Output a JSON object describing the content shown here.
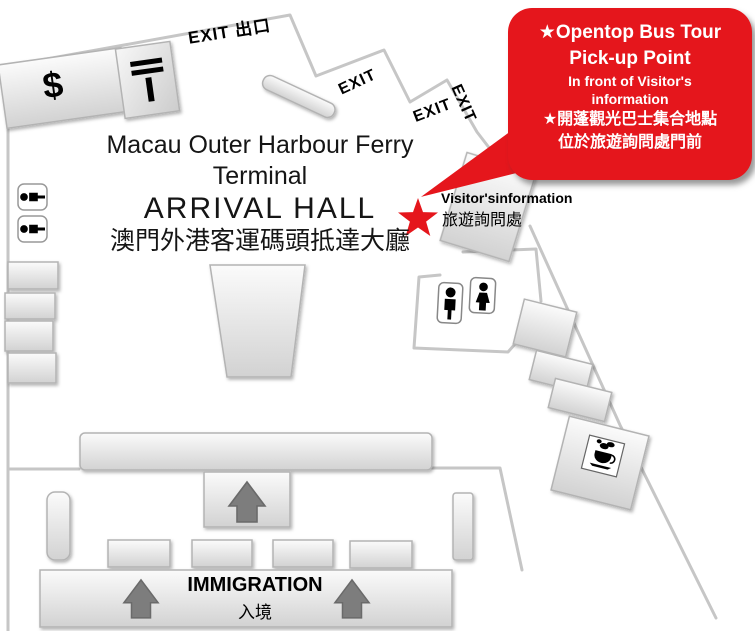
{
  "callout": {
    "en_title_1": "★Opentop Bus Tour",
    "en_title_2": "Pick-up Point",
    "en_sub_1": "In front of Visitor's",
    "en_sub_2": "information",
    "zh_1": "★開蓬觀光巴士集合地點",
    "zh_2": "位於旅遊詢問處門前"
  },
  "terminal": {
    "name_en_1": "Macau Outer Harbour Ferry",
    "name_en_2": "Terminal",
    "hall_en": "ARRIVAL HALL",
    "hall_zh": "澳門外港客運碼頭抵達大廳"
  },
  "exits": {
    "main": "EXIT 出口",
    "exit_1": "EXIT",
    "exit_2": "EXIT",
    "exit_3": "EXIT"
  },
  "visitor_info": {
    "en": "Visitor'sinformation",
    "zh": "旅遊詢問處"
  },
  "immigration": {
    "en": "IMMIGRATION",
    "zh": "入境"
  },
  "facilities": {
    "currency_sign": "$"
  },
  "icons": {
    "pickup_star": "★",
    "exchange_counter": "double-bar-T-icon",
    "male_restroom": "male-restroom-icon",
    "female_restroom": "female-restroom-icon",
    "cafe": "coffee-cup-icon",
    "direction": "up-arrow-icon"
  },
  "colors": {
    "accent_red": "#e5161c",
    "wall_gray": "#c6c6c6",
    "arrow_gray": "#7d7d7d"
  }
}
